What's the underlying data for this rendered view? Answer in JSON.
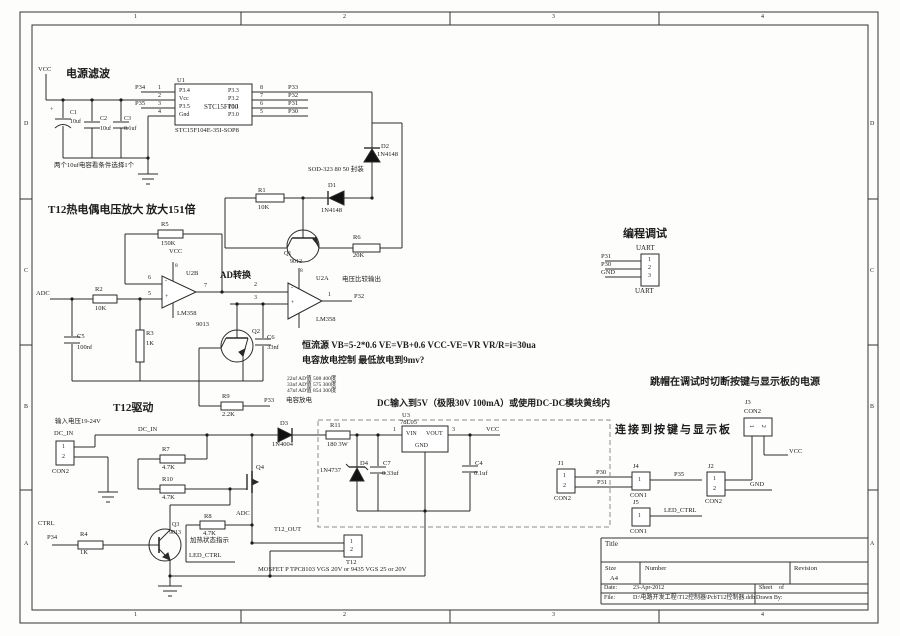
{
  "frame": {
    "cols": [
      "1",
      "2",
      "3",
      "4"
    ],
    "rows": [
      "D",
      "C",
      "B",
      "A"
    ]
  },
  "power": {
    "title": "电源滤波",
    "vcc": "VCC",
    "c1": "C1",
    "c1v": "10uf",
    "c1p": "+",
    "c2": "C2",
    "c2v": "10uf",
    "c3": "C3",
    "c3v": "0.1uf",
    "note": "两个10uf电容看条件选择1个"
  },
  "mcu": {
    "ref": "U1",
    "name": "STC15F100",
    "pkg": "STC15F104E-35I-SOP8",
    "p1name": "P3.4",
    "p2name": "Vcc",
    "p3name": "P3.5",
    "p4name": "Gnd",
    "p8name": "P3.3",
    "p7name": "P3.2",
    "p6name": "P3.1",
    "p5name": "P3.0",
    "n1": "1",
    "n2": "2",
    "n3": "3",
    "n4": "4",
    "n5": "5",
    "n6": "6",
    "n7": "7",
    "n8": "8",
    "net_p34": "P34",
    "net_p35": "P35",
    "net_p33": "P33",
    "net_p32": "P32",
    "net_p31": "P31",
    "net_p30": "P30"
  },
  "top": {
    "d2": "D2",
    "d2v": "1N4148",
    "sod": "SOD-323 80 50 封装",
    "d1": "D1",
    "d1v": "1N4148",
    "r1": "R1",
    "r1v": "10K"
  },
  "amp": {
    "title": "T12热电偶电压放大  放大151倍",
    "adc": "ADC",
    "r2": "R2",
    "r2v": "10K",
    "c5": "C5",
    "c5v": "100nf",
    "r3": "R3",
    "r3v": "1K",
    "r5": "R5",
    "r5v": "150K",
    "vcc": "VCC",
    "u2b": "U2B",
    "adlabel": "AD转换",
    "lm358b": "LM358",
    "q1": "Q1",
    "q1v": "9012",
    "r6": "R6",
    "r6v": "20K",
    "u2a": "U2A",
    "cmp": "电压比较输出",
    "lm358a": "LM358",
    "p32": "P32",
    "pin1": "1",
    "pin2": "2",
    "pin3": "3",
    "pin5": "5",
    "pin6": "6",
    "pin7": "7",
    "pin8": "8",
    "plus": "+",
    "minus": "-",
    "q2": "Q2",
    "q2v": "9013",
    "c6": "C6",
    "c6v": "33nf",
    "r9": "R9",
    "r9v": "2.2K",
    "p33": "P33",
    "discharge": "电容放电"
  },
  "notes": {
    "cc": "恒流源 VB=5-2*0.6 VE=VB+0.6 VCC-VE=VR VR/R=i=30ua",
    "dis": "电容放电控制 最低放电到9mv?",
    "ad1": "22nf AD值 508 400度",
    "ad2": "33nf AD值 575 300度",
    "ad3": "47nf AD值 854 300度"
  },
  "drv": {
    "title": "T12驱动",
    "inote": "输入电压19-24V",
    "dcin": "DC_IN",
    "dcin_net": "DC_IN",
    "con2": "CON2",
    "p1": "1",
    "p2": "2",
    "r7": "R7",
    "r7v": "4.7K",
    "r10": "R10",
    "r10v": "4.7K",
    "q4": "Q4",
    "d3": "D3",
    "d3v": "1N4004",
    "ctrl": "CTRL",
    "p34": "P34",
    "r4": "R4",
    "r4v": "1K",
    "q3": "Q3",
    "q3v": "9013",
    "r8": "R8",
    "r8v": "4.7K",
    "adc": "ADC",
    "heat": "加热状态指示",
    "led": "LED_CTRL",
    "t12out": "T12_OUT",
    "t12": "T12",
    "mosnote": "MOSFET P TPC8103 VGS 20V or 9435 VGS 25 or 20V"
  },
  "reg": {
    "note": "DC输入到5V（极限30V 100mA）或使用DC-DC模块黄线内",
    "r11": "R11",
    "r11v": "180 3W",
    "d4": "D4",
    "d4v": "1N4737",
    "c7": "C7",
    "c7v": "0.33uf",
    "u3": "U3",
    "u3v": "78L05",
    "vin": "VIN",
    "vout": "VOUT",
    "gnd": "GND",
    "p1": "1",
    "p3": "3",
    "c4": "C4",
    "c4v": "0.1uf",
    "vcc": "VCC"
  },
  "uart": {
    "title": "编程调试",
    "top": "UART",
    "bottom": "UART",
    "p31": "P31",
    "p30": "P30",
    "gnd": "GND",
    "n1": "1",
    "n2": "2",
    "n3": "3"
  },
  "io": {
    "jumper_note": "跳帽在调试时切断按键与显示板的电源",
    "connect_note": "连接到按键与显示板",
    "j1": "J1",
    "j1t": "CON2",
    "j2": "J2",
    "j2t": "CON2",
    "j3": "J3",
    "j3t": "CON2",
    "j4": "J4",
    "j4t": "CON1",
    "j5": "J5",
    "j5t": "CON1",
    "p30": "P30",
    "p31": "P31",
    "p35": "P35",
    "gnd": "GND",
    "led": "LED_CTRL",
    "vcc": "VCC",
    "n1": "1",
    "n2": "2"
  },
  "tb": {
    "title": "Title",
    "size": "Size",
    "a4": "A4",
    "number": "Number",
    "revision": "Revision",
    "date": "Date:",
    "datev": "23-Apr-2012",
    "sheet": "Sheet",
    "of": "of",
    "file": "File:",
    "filev": "D:\\电路开发工程\\T12控制器\\PcbT12控制器.ddb",
    "drawn": "Drawn By:"
  }
}
